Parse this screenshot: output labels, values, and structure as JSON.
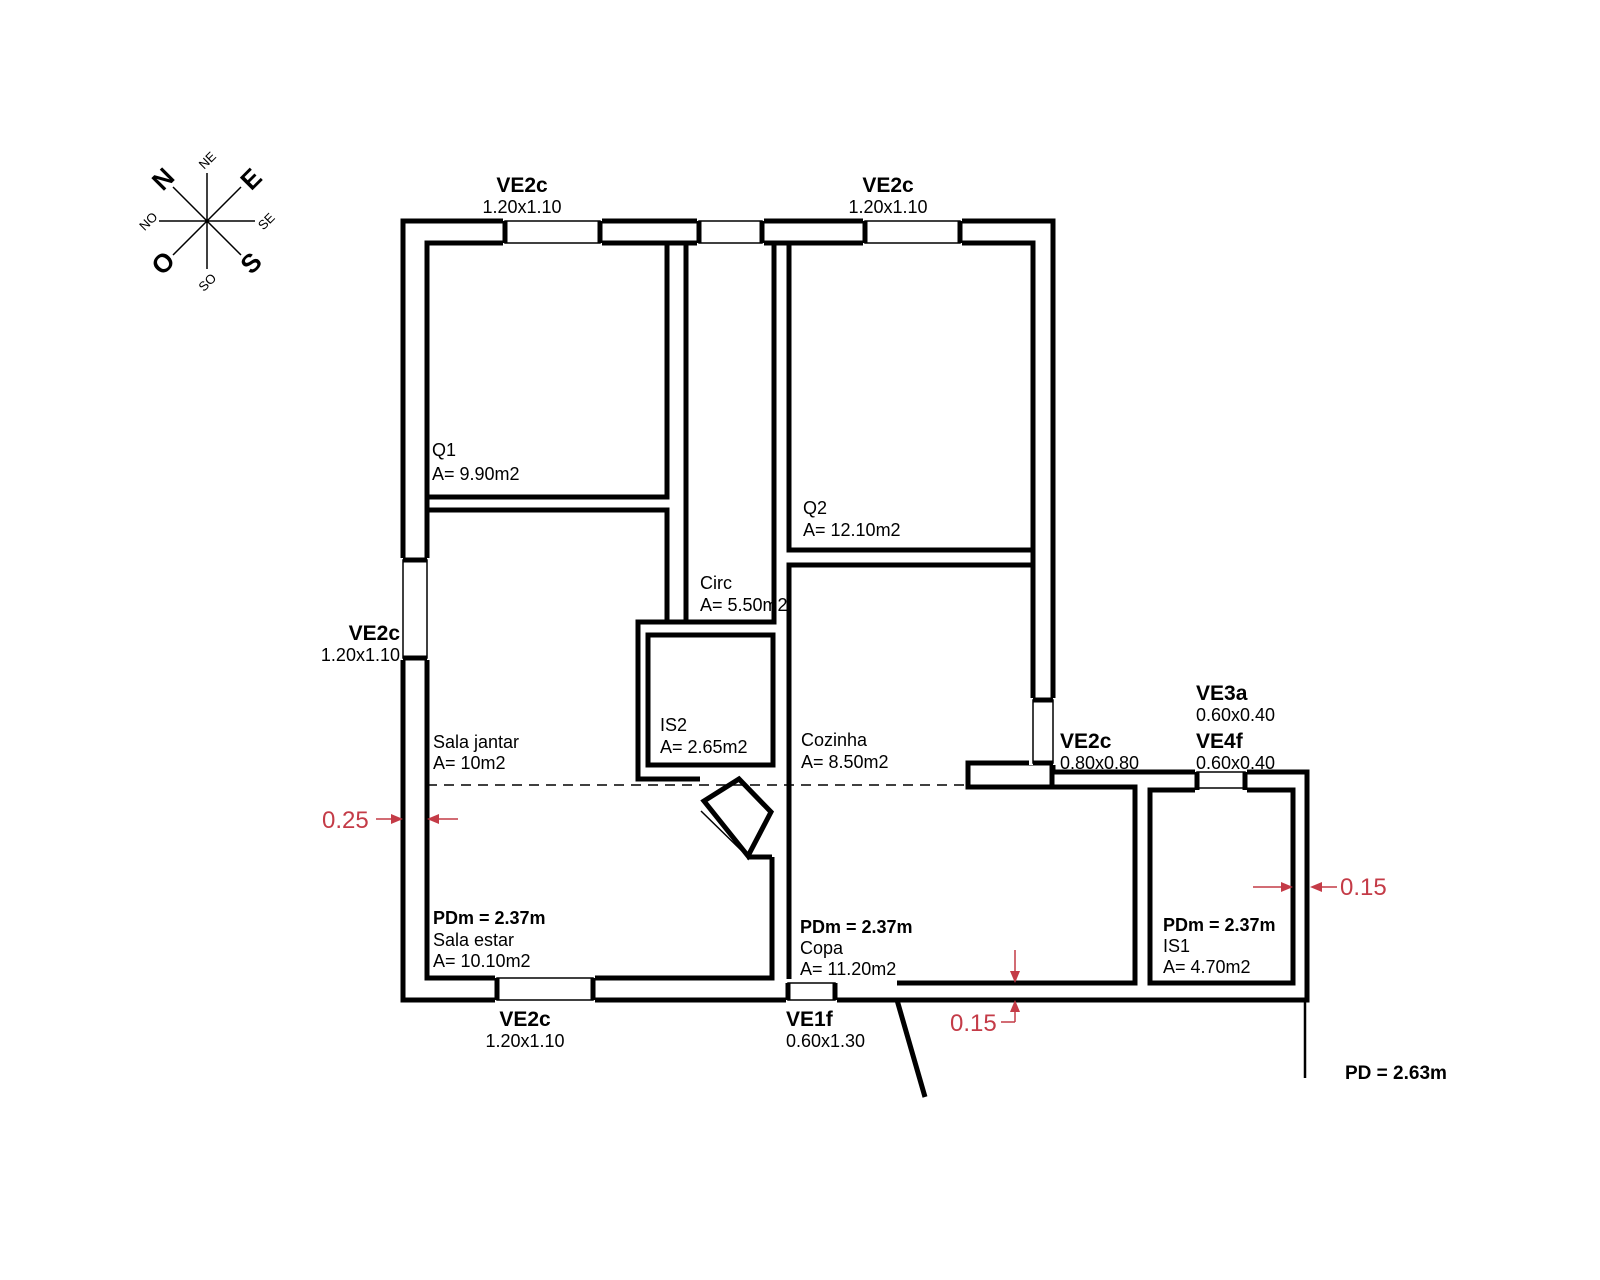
{
  "windows": [
    {
      "name": "VE2c",
      "size": "1.20x1.10"
    },
    {
      "name": "VE2c",
      "size": "1.20x1.10"
    },
    {
      "name": "VE2c",
      "size": "1.20x1.10"
    },
    {
      "name": "VE2c",
      "size": "1.20x1.10"
    },
    {
      "name": "VE1f",
      "size": "0.60x1.30"
    },
    {
      "name": "VE2c",
      "size": "0.80x0.80"
    },
    {
      "name": "VE3a",
      "size": "0.60x0.40"
    },
    {
      "name": "VE4f",
      "size": "0.60x0.40"
    }
  ],
  "rooms": [
    {
      "name": "Q1",
      "area": "A= 9.90m2"
    },
    {
      "name": "Q2",
      "area": "A= 12.10m2"
    },
    {
      "name": "Circ",
      "area": "A= 5.50m2"
    },
    {
      "name": "IS2",
      "area": "A= 2.65m2"
    },
    {
      "name": "Cozinha",
      "area": "A= 8.50m2"
    },
    {
      "name": "Sala jantar",
      "area": "A= 10m2"
    },
    {
      "name": "Sala estar",
      "area": "A= 10.10m2",
      "ceiling": "PDm = 2.37m"
    },
    {
      "name": "Copa",
      "area": "A= 11.20m2",
      "ceiling": "PDm = 2.37m"
    },
    {
      "name": "IS1",
      "area": "A= 4.70m2",
      "ceiling": "PDm = 2.37m"
    }
  ],
  "dimensions": {
    "left_wall": "0.25",
    "bottom_wall": "0.15",
    "right_wall": "0.15"
  },
  "ceiling_note": "PD = 2.63m",
  "compass": {
    "n": "N",
    "ne": "NE",
    "e": "E",
    "se": "SE",
    "s": "S",
    "so": "SO",
    "o": "O",
    "no": "NO"
  },
  "colors": {
    "ink": "#000000",
    "dimension_red": "#c43b47"
  }
}
